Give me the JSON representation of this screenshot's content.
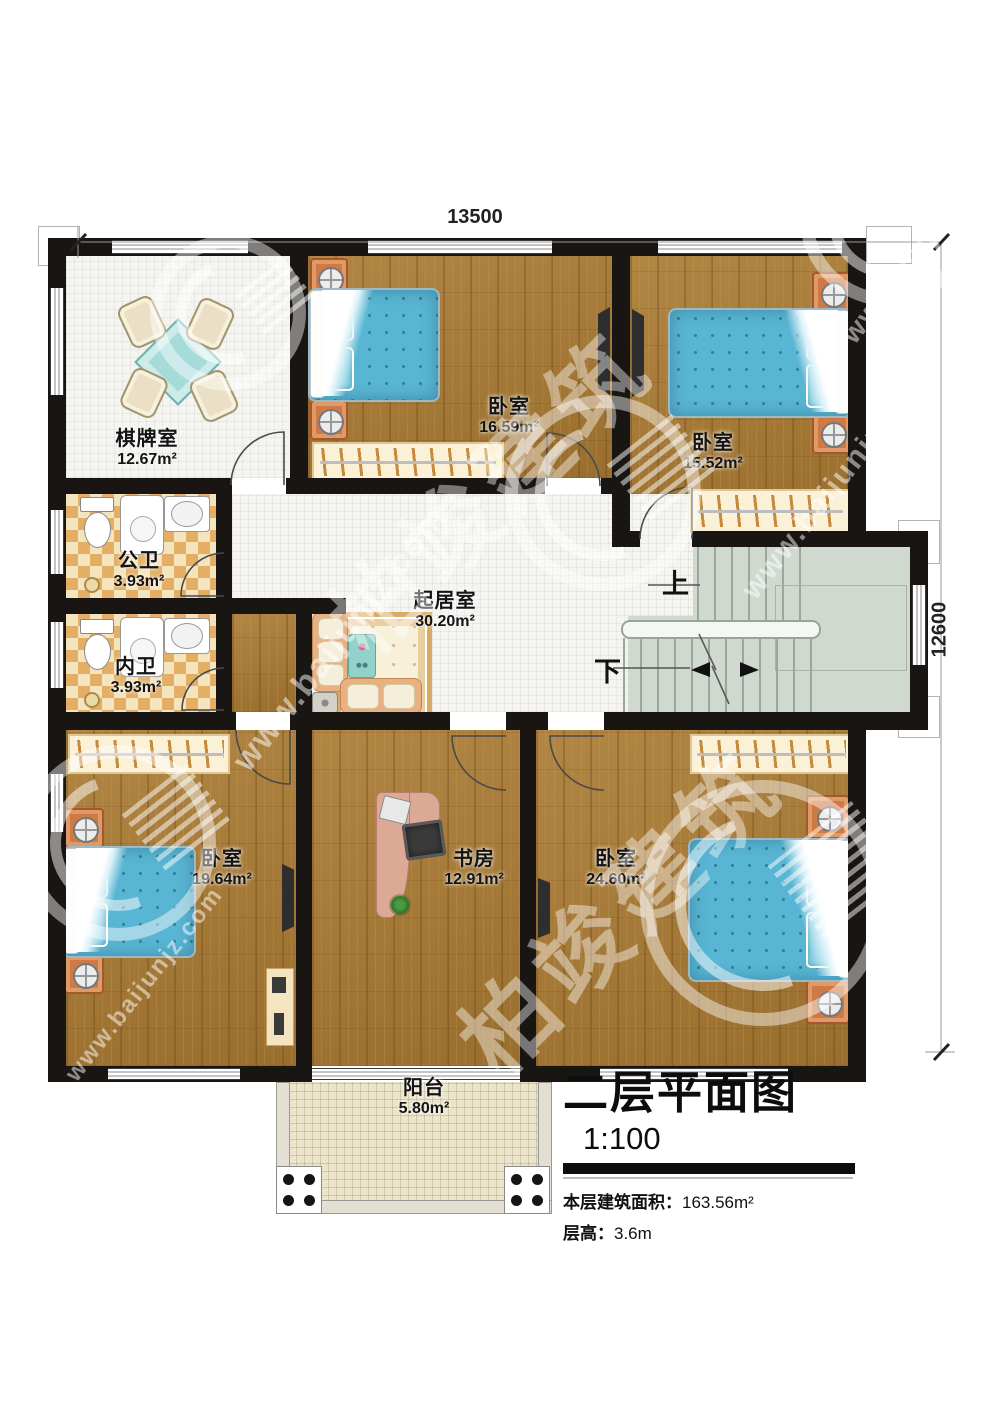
{
  "dimensions": {
    "top": "13500",
    "right": "12600"
  },
  "title_block": {
    "title": "二层平面图",
    "scale": "1:100",
    "area_label": "本层建筑面积：",
    "area_value": "163.56m²",
    "height_label": "层高：",
    "height_value": "3.6m"
  },
  "stairs": {
    "up_label": "上",
    "down_label": "下"
  },
  "rooms": [
    {
      "name": "棋牌室",
      "area": "12.67m²"
    },
    {
      "name": "卧室",
      "area": "16.59m²"
    },
    {
      "name": "卧室",
      "area": "15.52m²"
    },
    {
      "name": "公卫",
      "area": "3.93m²"
    },
    {
      "name": "内卫",
      "area": "3.93m²"
    },
    {
      "name": "起居室",
      "area": "30.20m²"
    },
    {
      "name": "卧室",
      "area": "19.64m²"
    },
    {
      "name": "书房",
      "area": "12.91m²"
    },
    {
      "name": "卧室",
      "area": "24.60m²"
    },
    {
      "name": "阳台",
      "area": "5.80m²"
    }
  ],
  "watermark": {
    "brand": "柏竣建筑",
    "url": "www.baijunjz.com"
  },
  "colors": {
    "wall": "#181512",
    "wood_floor": "#ab7b33",
    "tile_floor": "#f4f4f1",
    "bath_checker": "#e4ae64",
    "stair_floor": "#d0d9d0",
    "balcony_floor": "#ece5cb",
    "bed_fabric": "#58b5d3",
    "nightstand": "#cf7a44",
    "wardrobe": "#fbf1d7"
  }
}
